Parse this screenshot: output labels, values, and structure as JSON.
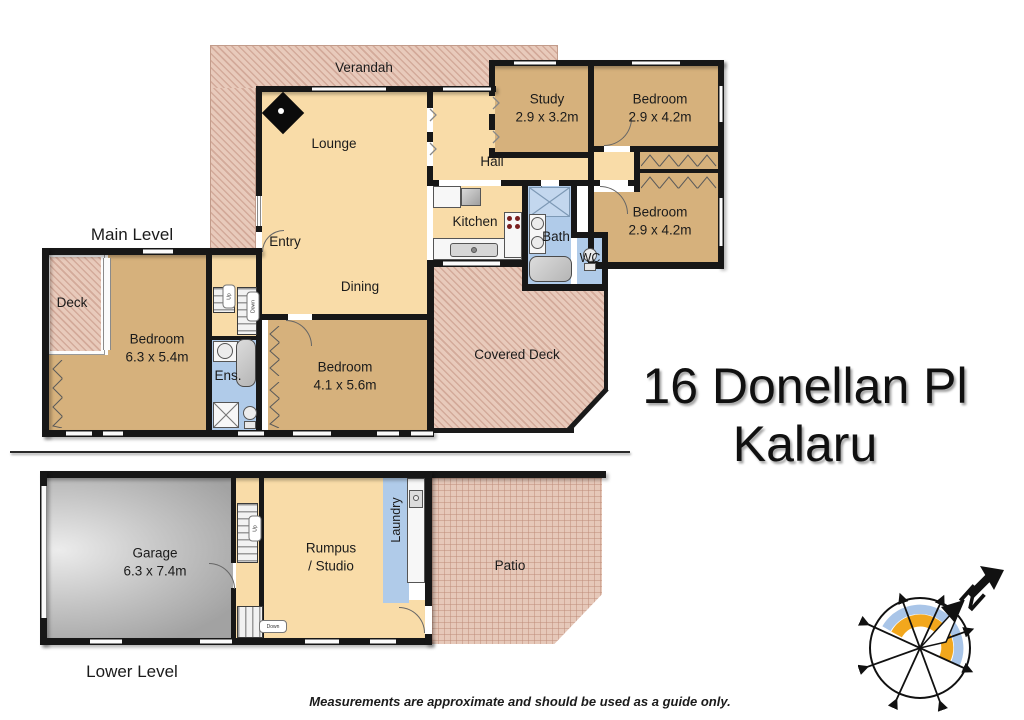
{
  "address": {
    "line1": "16 Donellan Pl",
    "line2": "Kalaru"
  },
  "levels": {
    "main": "Main Level",
    "lower": "Lower Level"
  },
  "disclaimer": "Measurements are approximate and should be used as a guide only.",
  "compass": {
    "north": "N"
  },
  "stairs": {
    "up": "Up",
    "down": "Down"
  },
  "rooms": {
    "verandah": {
      "name": "Verandah"
    },
    "lounge": {
      "name": "Lounge"
    },
    "hall": {
      "name": "Hall"
    },
    "study": {
      "name": "Study",
      "dims": "2.9 x 3.2m"
    },
    "bedroom_ne": {
      "name": "Bedroom",
      "dims": "2.9 x 4.2m"
    },
    "bedroom_e": {
      "name": "Bedroom",
      "dims": "2.9 x 4.2m"
    },
    "kitchen": {
      "name": "Kitchen"
    },
    "bath": {
      "name": "Bath"
    },
    "wc": {
      "name": "WC"
    },
    "entry": {
      "name": "Entry"
    },
    "dining": {
      "name": "Dining"
    },
    "covered_deck": {
      "name": "Covered Deck"
    },
    "deck": {
      "name": "Deck"
    },
    "bedroom_main": {
      "name": "Bedroom",
      "dims": "6.3 x 5.4m"
    },
    "ensuite": {
      "name": "Ens."
    },
    "bedroom_s": {
      "name": "Bedroom",
      "dims": "4.1 x 5.6m"
    },
    "garage": {
      "name": "Garage",
      "dims": "6.3 x 7.4m"
    },
    "rumpus": {
      "name": "Rumpus",
      "name2": "/ Studio"
    },
    "laundry": {
      "name": "Laundry"
    },
    "patio": {
      "name": "Patio"
    }
  },
  "colors": {
    "wall": "#171717",
    "living": "#f9dca8",
    "bedroom": "#d6b17c",
    "wet_area": "#b0cbe9",
    "outdoor_hatch": "#e8cabb",
    "compass_orange": "#f2a71d",
    "compass_blue": "#a9c5e8"
  }
}
